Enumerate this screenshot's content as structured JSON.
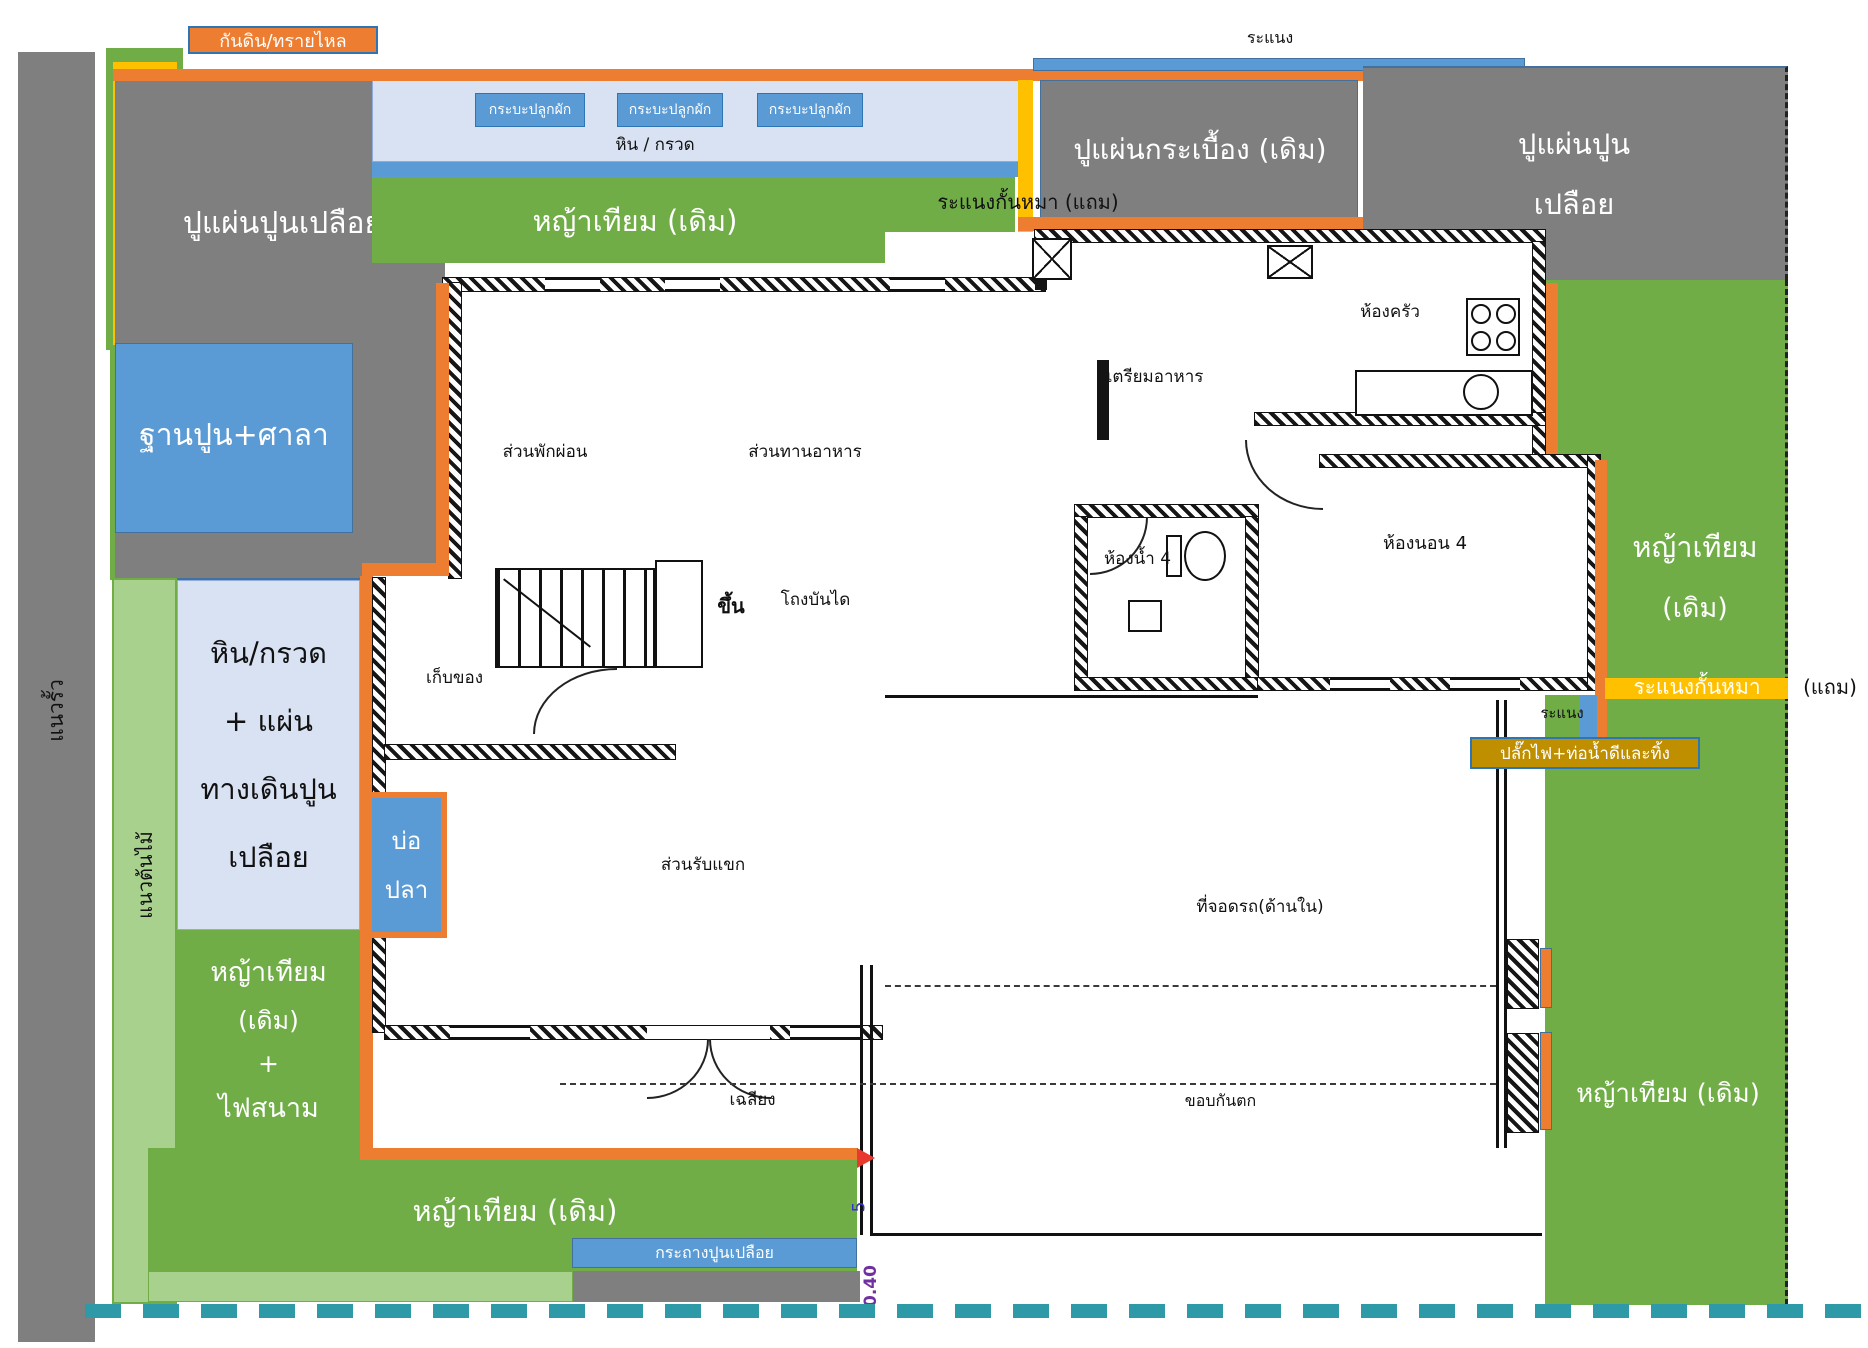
{
  "title": "แปลนบ้านและผังจัดสวน",
  "colors": {
    "orange": "#ED7D31",
    "yellow": "#FFC000",
    "green": "#70AD47",
    "light_green": "#A9D18E",
    "gray": "#7F7F7F",
    "blue": "#5B9BD5",
    "light_blue": "#D9E2F3",
    "olive": "#BF8F00",
    "teal_dash": "#2E9AA8",
    "border_blue": "#2E75B6",
    "dim_purple": "#7030A0",
    "red_arrow": "#E8392E"
  },
  "labels": {
    "soil_sand_tag": "กันดิน/ทรายไหล",
    "lattice_top": "ระแนง",
    "modern_garden": "สวนโมเดิร์น (แถม)",
    "fence_line": "แนวรั้ว",
    "tree_line": "แนวต้นไม้",
    "bare_concrete_nw": "ปูแผ่นปูนเปลือย",
    "planter_box": "กระบะปลูกผัก",
    "stone_gravel": "หิน / กรวด",
    "grass_top": "หญ้าเทียม (เดิม)",
    "dog_lattice_top": "ระแนงกั้นหมา (แถม)",
    "tile_paving": "ปูแผ่นกระเบื้อง (เดิม)",
    "bare_concrete_ne_1": "ปูแผ่นปูน",
    "bare_concrete_ne_2": "เปลือย",
    "cement_base": "ฐานปูน+ศาลา",
    "walkway_1": "หิน/กรวด",
    "walkway_2": "+ แผ่น",
    "walkway_3": "ทางเดินปูน",
    "walkway_4": "เปลือย",
    "pond_1": "บ่อ",
    "pond_2": "ปลา",
    "grass_e_1": "หญ้าเทียม",
    "grass_e_2": "(เดิม)",
    "dog_lattice_e": "ระแนงกั้นหมา",
    "dog_lattice_e_note": "(แถม)",
    "lattice_small": "ระแนง",
    "plug_pipe": "ปลั๊กไฟ+ท่อน้ำดีและทิ้ง",
    "grass_sw_1": "หญ้าเทียม",
    "grass_sw_2": "(เดิม)",
    "grass_sw_3": "+",
    "grass_sw_4": "ไฟสนาม",
    "grass_bottom": "หญ้าเทียม (เดิม)",
    "planter_strip": "กระถางปูนเปลือย",
    "grass_se": "หญ้าเทียม (เดิม)"
  },
  "rooms": {
    "relax": "ส่วนพักผ่อน",
    "dining": "ส่วนทานอาหาร",
    "prep": "เตรียมอาหาร",
    "kitchen": "ห้องครัว",
    "stair_hall": "โถงบันได",
    "storage": "เก็บของ",
    "up": "ขึ้น",
    "bath": "ห้องน้ำ 4",
    "bed": "ห้องนอน 4",
    "guest": "ส่วนรับแขก",
    "porch": "เฉลียง",
    "carport": "ที่จอดรถ(ด้านใน)",
    "curb": "ขอบกันตก"
  },
  "dims": {
    "d040": "0.40",
    "d5": "5"
  }
}
